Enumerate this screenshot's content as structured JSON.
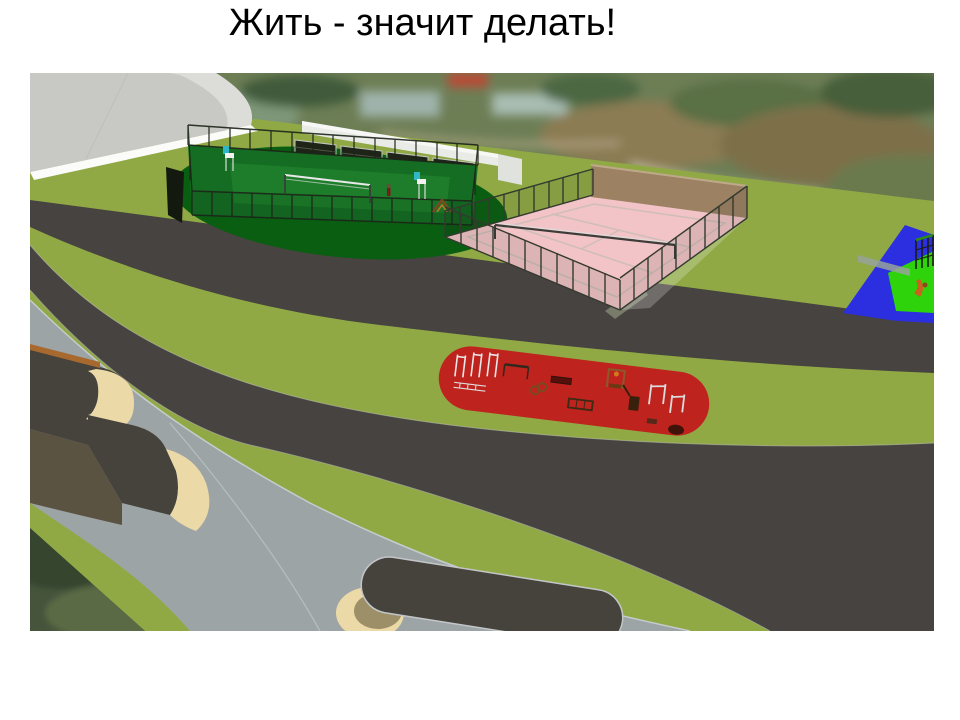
{
  "slide": {
    "title": "Жить - значит делать!"
  },
  "scene": {
    "areas": [
      "arch-building",
      "volleyball-court",
      "bleachers",
      "canopy",
      "tennis-court",
      "tennis-backwall",
      "street-workout-area",
      "children-playground",
      "skate-park-platform",
      "skate-ramp-pill",
      "upper-road",
      "lower-road",
      "plaza",
      "lawn",
      "aerial-photo-background"
    ],
    "colors": {
      "slide_bg": "#ffffff",
      "title_color": "#000000",
      "grass": "#90a945",
      "road": "#474340",
      "plaza": "#9da4a6",
      "plaza_edge": "#c6cbcd",
      "court_green": "#156d23",
      "court_green_inner": "#1d7d2b",
      "court_oval": "#0a5e12",
      "tennis_pink": "#f2c4c7",
      "tennis_wall": "#9c8263",
      "fence_dark": "#2c332a",
      "workout_red": "#bf231d",
      "playground_blue": "#2b2fe0",
      "playground_green": "#2ed30c",
      "ramp_tan": "#ecd9a8",
      "ramp_dark": "#46423c",
      "ramp_brown": "#5b5342",
      "coping_orange": "#a8692f",
      "building_gray": "#c8c8c5",
      "building_edge": "#fbfbf9",
      "canopy_white": "#e9ebe7",
      "bleacher_dark": "#1e2418",
      "photo_green": "#6d7e55",
      "photo_dark_green": "#46543c",
      "net_white": "#e8e8e8"
    }
  }
}
